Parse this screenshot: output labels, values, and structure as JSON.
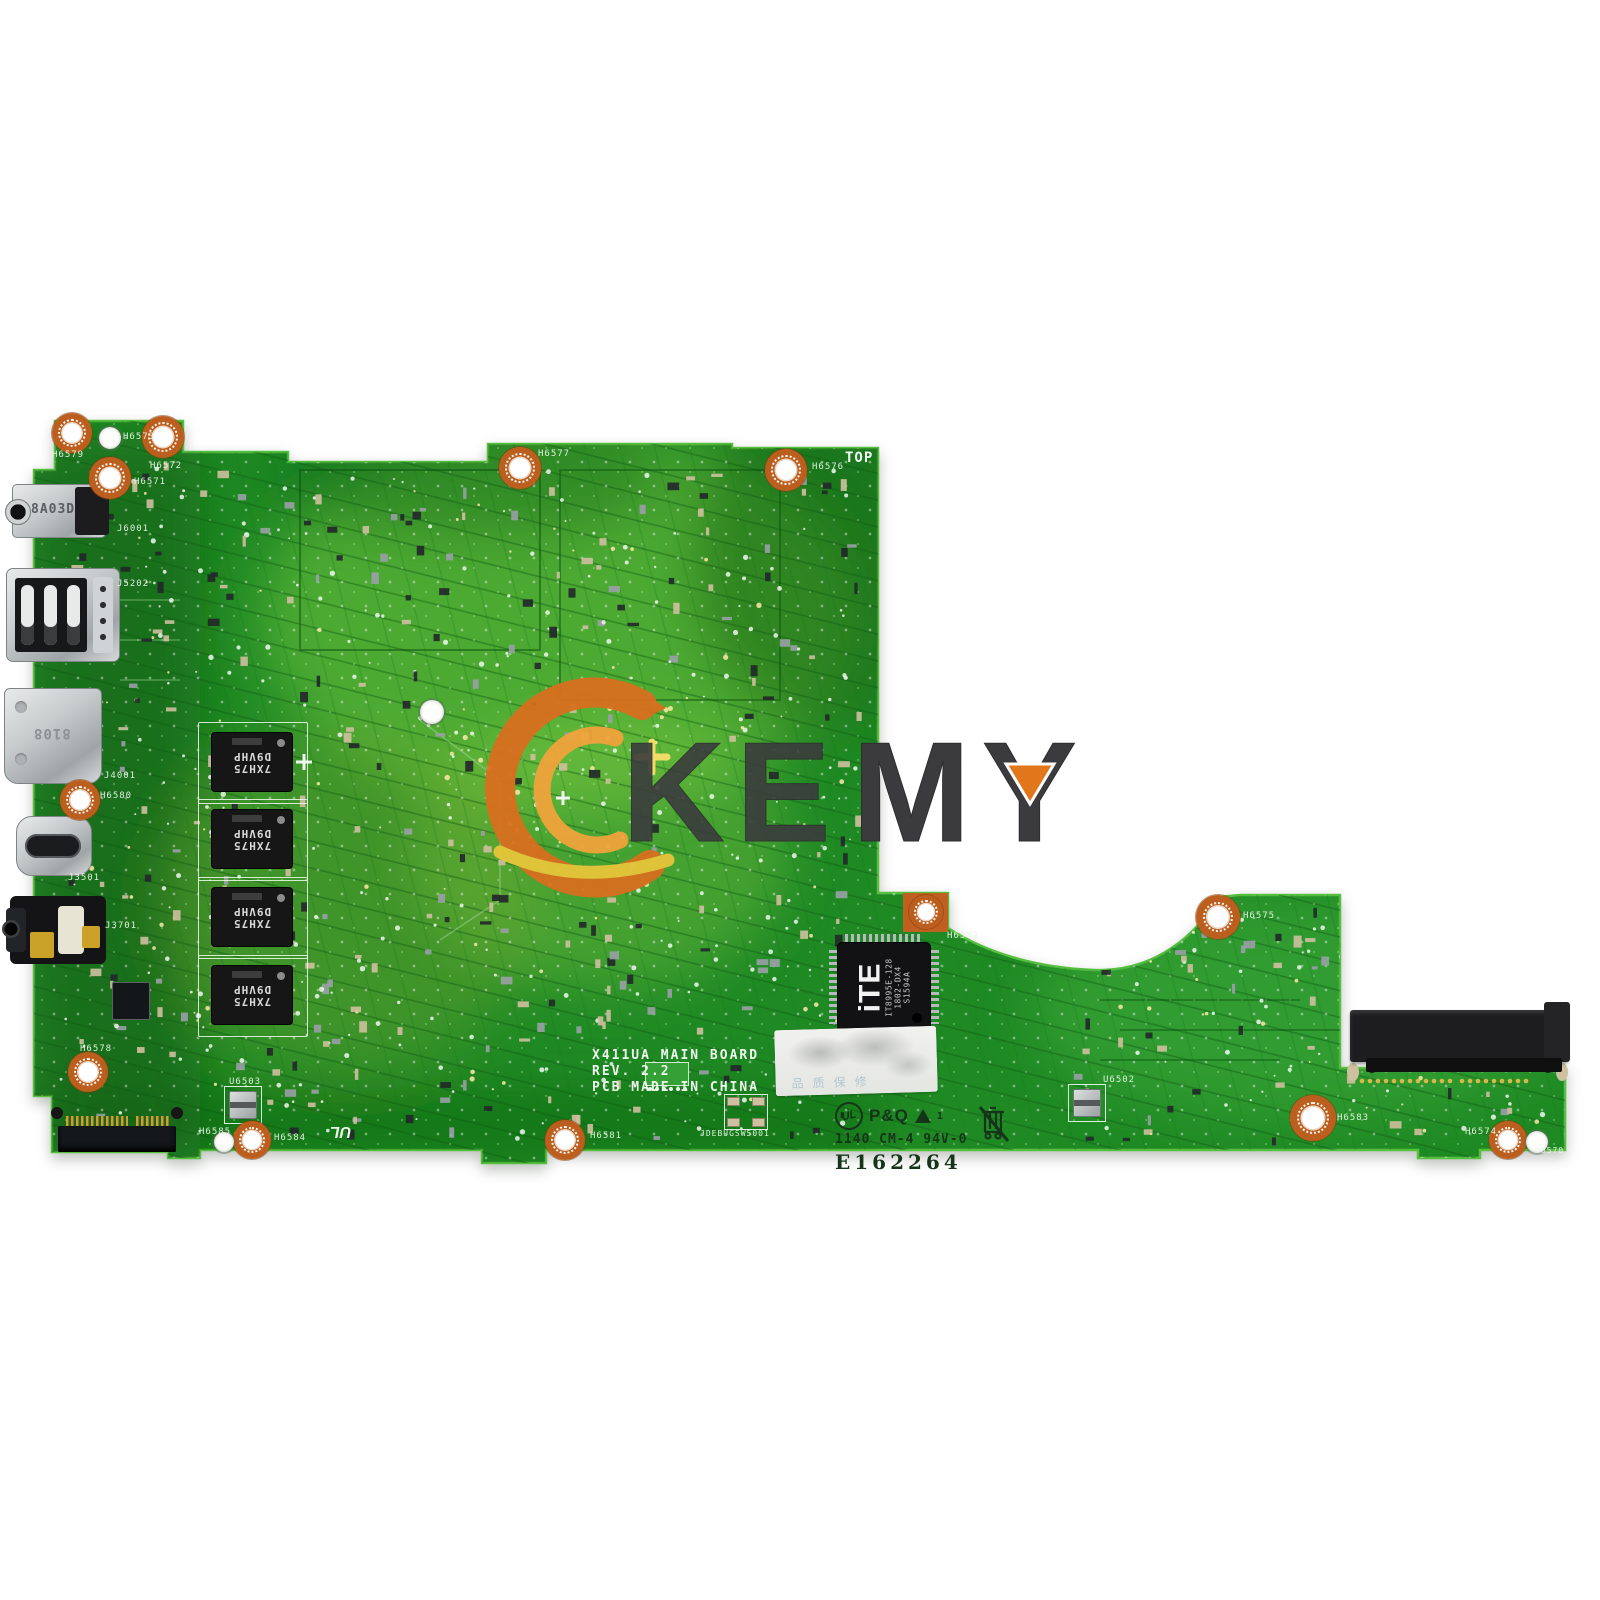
{
  "watermark": {
    "letter_k": "K",
    "letter_e": "E",
    "letter_m": "M",
    "letter_y": "Y",
    "logo_name": "akemy-a-swoosh",
    "accent_orange": "#e2761b",
    "accent_yellow": "#f0c419",
    "letter_color": "#3b3b3d"
  },
  "board": {
    "model_line1": "X411UA MAIN BOARD",
    "model_line2": "REV. 2.2",
    "model_line3": "PCB MADE IN CHINA",
    "top_marking": "TOP",
    "cert": {
      "ul": "UL",
      "pq": "P&Q",
      "triangle_note": "1",
      "date_code": "1140 CM-4 94V-0",
      "e_number": "E162264"
    },
    "refdes": {
      "h6573": "H6573",
      "h6579": "H6579",
      "h6572": "H6572",
      "h6571": "H6571",
      "j6001": "J6001",
      "h6577": "H6577",
      "h6576": "H6576",
      "j5202": "J5202",
      "j4001": "J4001",
      "h6580": "H6580",
      "j3501": "J3501",
      "j3701": "J3701",
      "h6578": "H6578",
      "u6503": "U6503",
      "h6585": "H6585",
      "h6584": "H6584",
      "h6581": "H6581",
      "jdebug": "JDEBUGSW5001",
      "h6582": "H6582",
      "h6575": "H6575",
      "u6502": "U6502",
      "h6583": "H6583",
      "h6574": "H6574",
      "h6570": "H6570"
    }
  },
  "components": {
    "dc_jack_marking": "8A03D",
    "hdmi_marking": "8108",
    "ec_chip": {
      "logo": "iTE",
      "line1": "IT8995E-128",
      "line2": "1802-DX4",
      "line3": "S1594A"
    },
    "ram_chip": {
      "line1": "7XH75",
      "line2": "D9VHP"
    },
    "sticker_faint_text": "品质保修"
  },
  "colors": {
    "pcb_green": "#1f8a24",
    "pcb_light": "#6abf3a",
    "pcb_dark": "#0e5a12",
    "copper": "#bc5f1e",
    "silkscreen": "#e9f6e9",
    "background": "#ffffff"
  }
}
